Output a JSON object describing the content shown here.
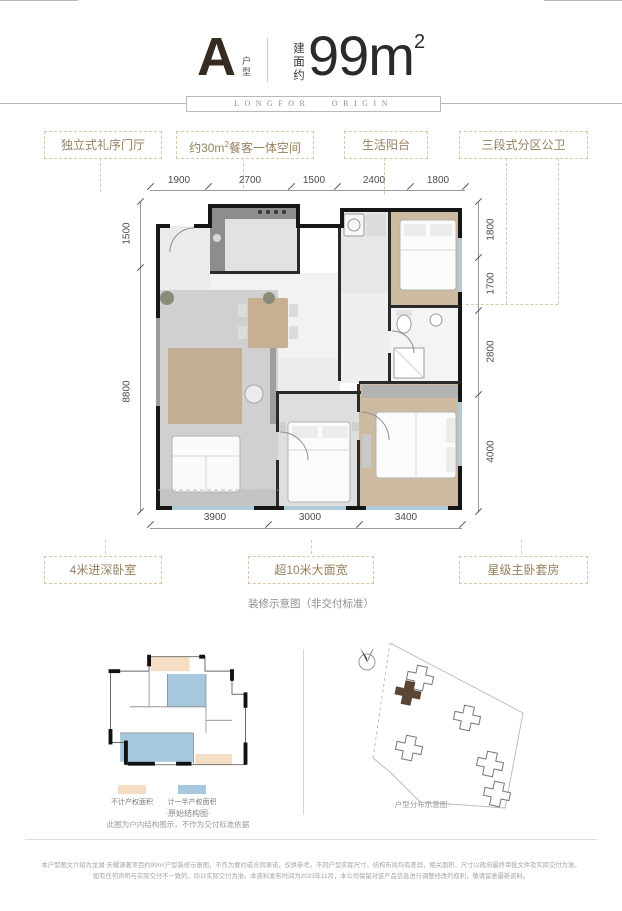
{
  "header": {
    "type_letter": "A",
    "type_label": "户型",
    "area_prefix": "建面约",
    "area_value": "99m",
    "area_exponent": "2",
    "banner_text": "LONGFOR ORIGIN"
  },
  "callouts_top": {
    "entry": "独立式礼序门厅",
    "dining_pre": "约30m",
    "dining_sup": "2",
    "dining_post": "餐客一体空间",
    "balcony": "生活阳台",
    "bath": "三段式分区公卫"
  },
  "dims": {
    "top": [
      "1900",
      "2700",
      "1500",
      "2400",
      "1800"
    ],
    "left": [
      "1500",
      "8800"
    ],
    "right": [
      "1800",
      "1700",
      "2800",
      "4000"
    ],
    "bottom": [
      "3900",
      "3000",
      "3400"
    ]
  },
  "callouts_bottom": {
    "bedroom": "4米进深卧室",
    "width": "超10米大面宽",
    "master": "星级主卧套房"
  },
  "plan_note": "装修示意图（非交付标准）",
  "structure_panel": {
    "legend_tan": "不计产权面积",
    "legend_blue": "计一半产权面积",
    "title": "·原始结构图·",
    "caption": "此图为户内结构图示，不作为交付标准依据"
  },
  "site_panel": {
    "caption": "·户型分布示意图·"
  },
  "disclaimer": {
    "line1": "本户型图文介绍为龙湖·天曜源著项目约99m²户型装修示意图，不作为要约或合同承诺，仅供参考。不同户型实际尺寸、结构布局均有差异，相关面积、尺寸以政府最终审批文件及实际交付为准。",
    "line2": "如有任何声明与实际交付不一致的，均以实际交付为准。本资料发布时间为2023年11月，本公司保留对该产品信息进行调整修改的权利，敬请留意最新资料。"
  },
  "colors": {
    "accent_tan": "#dcc5a6",
    "callout_text": "#97805f",
    "wall_black": "#161616",
    "window_blue": "#aecbd9",
    "wood": "#ccbaa1",
    "highlight_brown": "#5a4636",
    "legend_tan": "#f4ddc2",
    "legend_blue": "#a5c8de"
  }
}
